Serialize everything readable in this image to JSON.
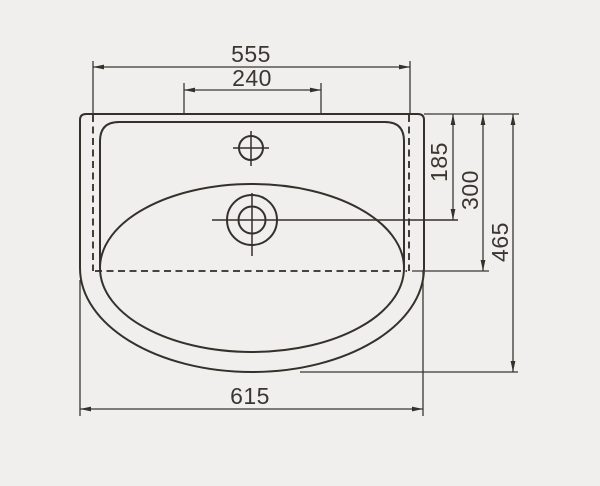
{
  "page": {
    "background_color": "#f0efed"
  },
  "drawing": {
    "subject": "washbasin-top-view-dimension-drawing",
    "stroke_color": "#34312b",
    "text_color": "#3a3731",
    "labels": {
      "top_width": "555",
      "tap_platform_width": "240",
      "top_to_drain_depth": "185",
      "top_to_ledge_depth": "300",
      "overall_depth": "465",
      "overall_width": "615"
    }
  }
}
